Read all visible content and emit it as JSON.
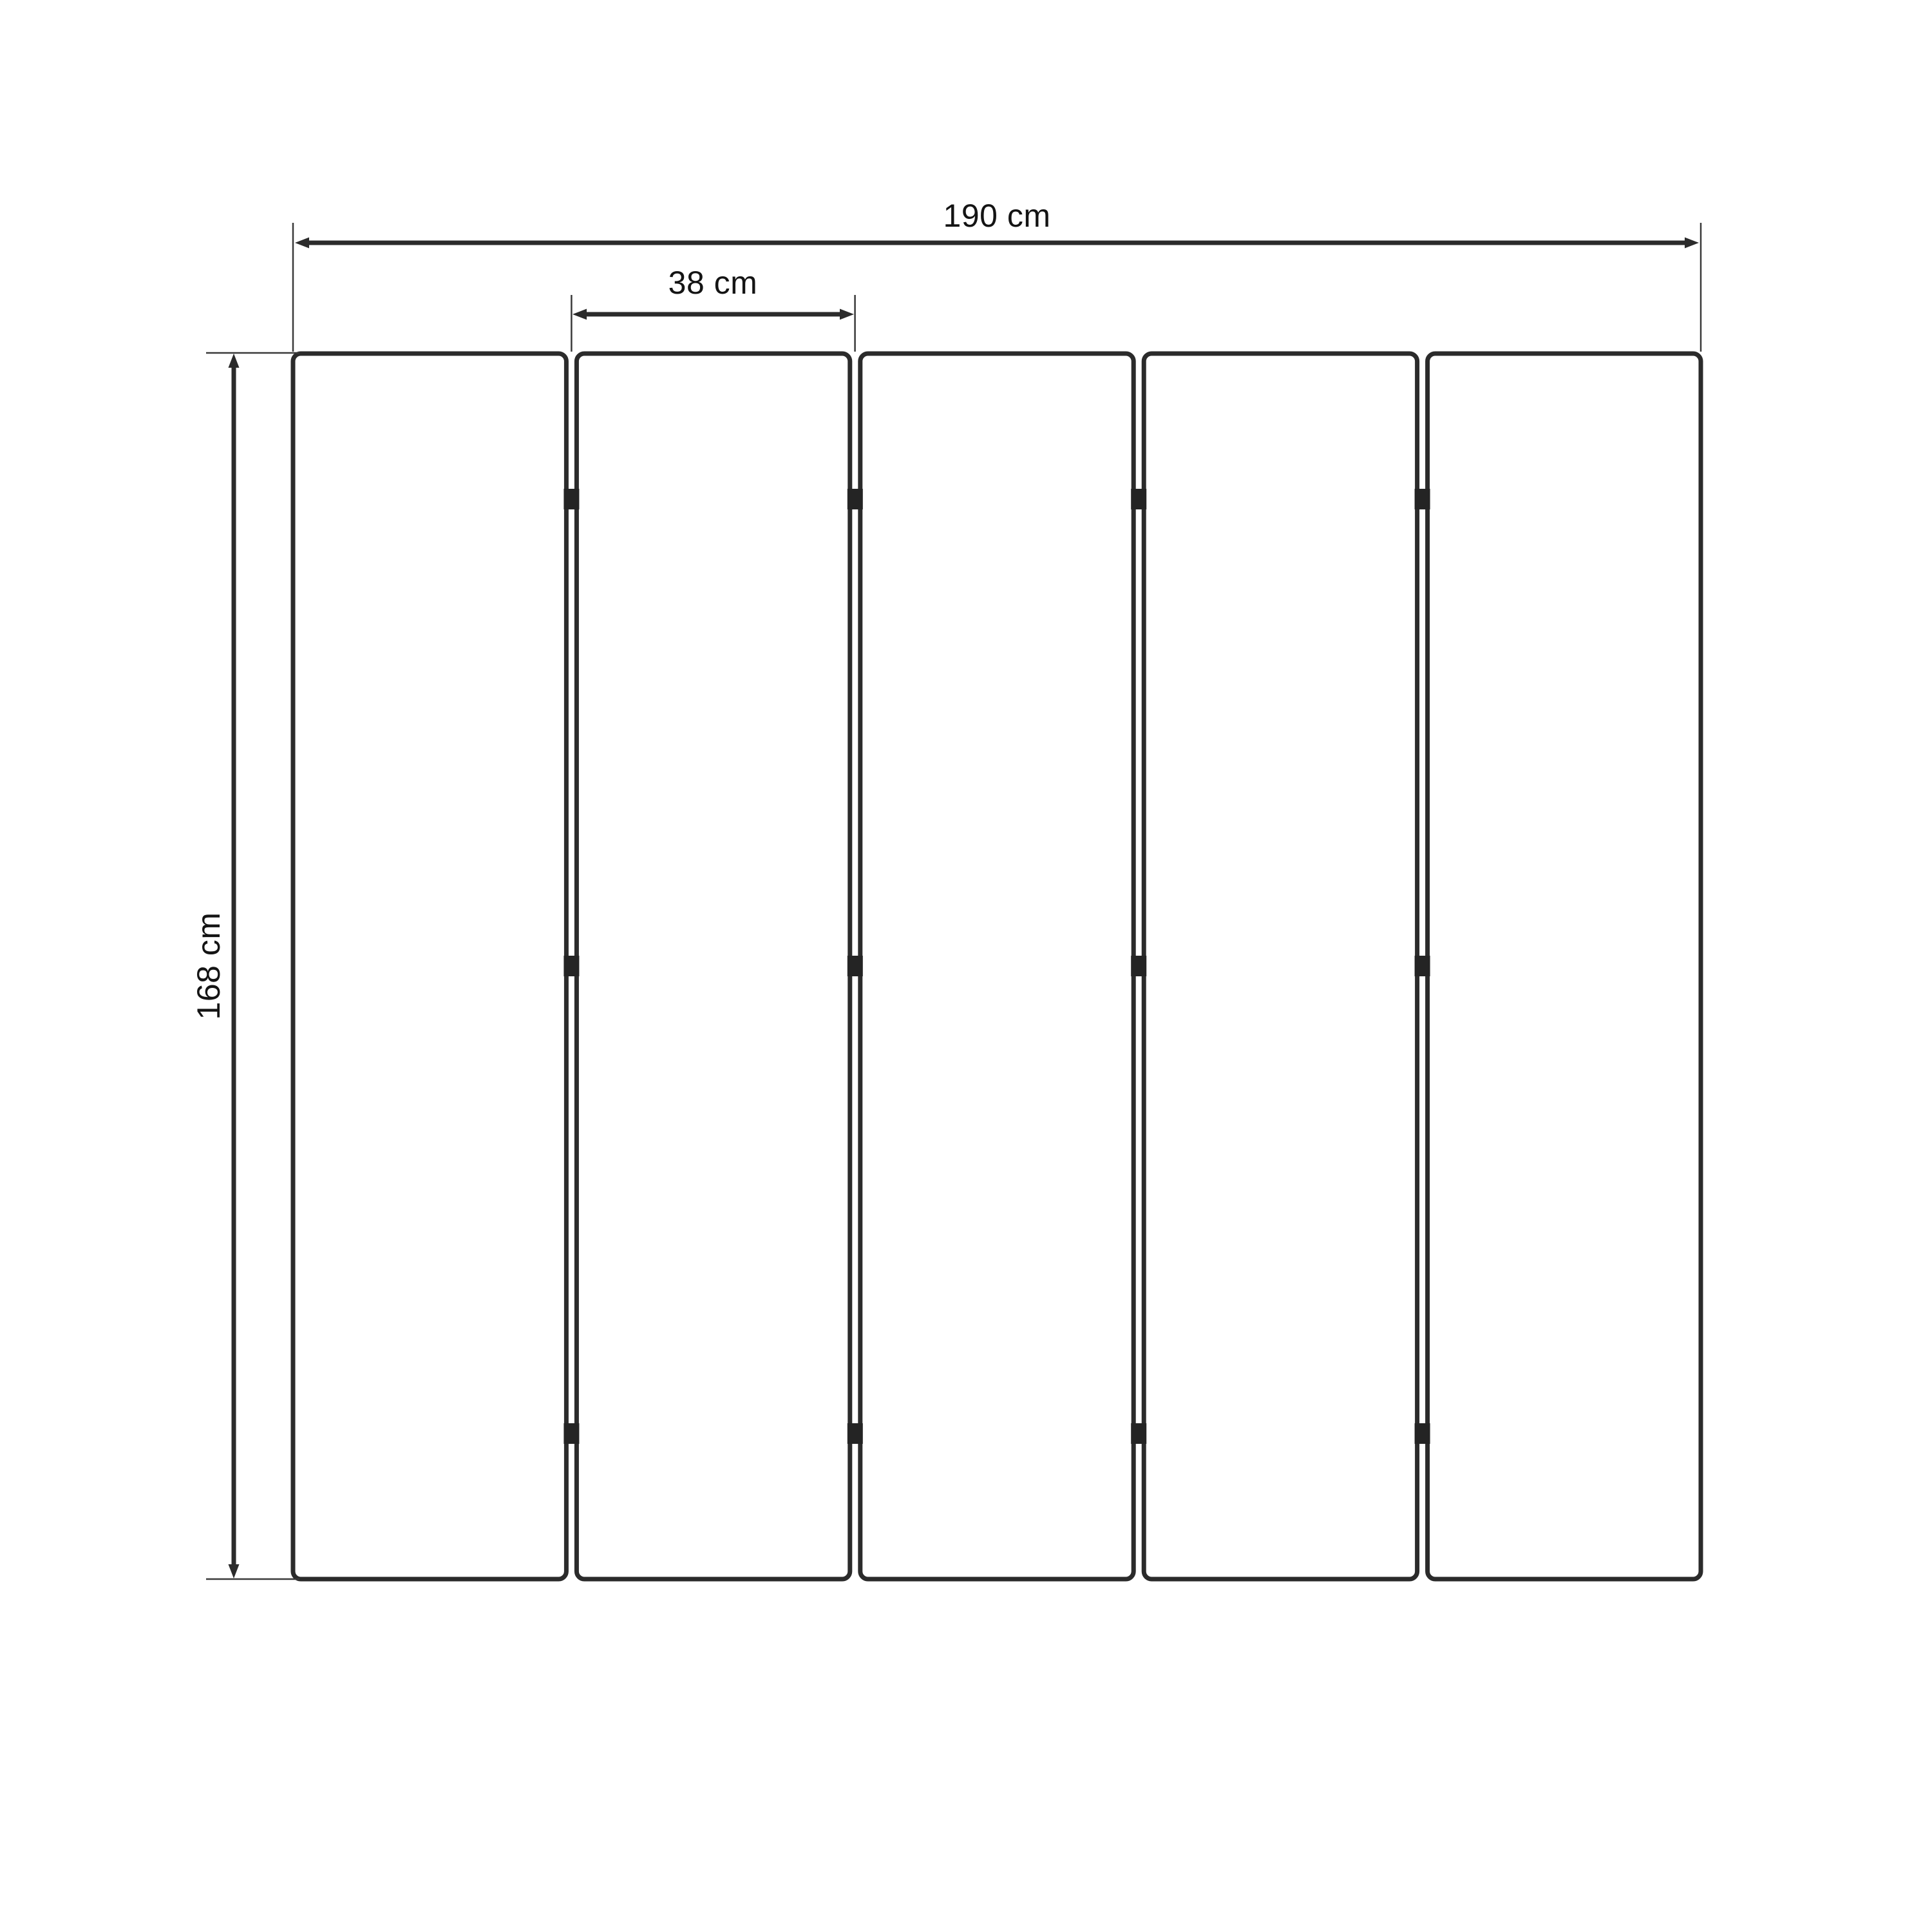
{
  "diagram": {
    "type": "folding-screen-dimension-drawing",
    "panel_count": 5,
    "hinge_rows": 3,
    "labels": {
      "total_width": "190 cm",
      "panel_width": "38 cm",
      "height": "168 cm"
    },
    "colors": {
      "background": "#ffffff",
      "outline": "#2b2b2b",
      "thin_line": "#3a3a3a",
      "hinge": "#242424",
      "text": "#141414"
    }
  }
}
